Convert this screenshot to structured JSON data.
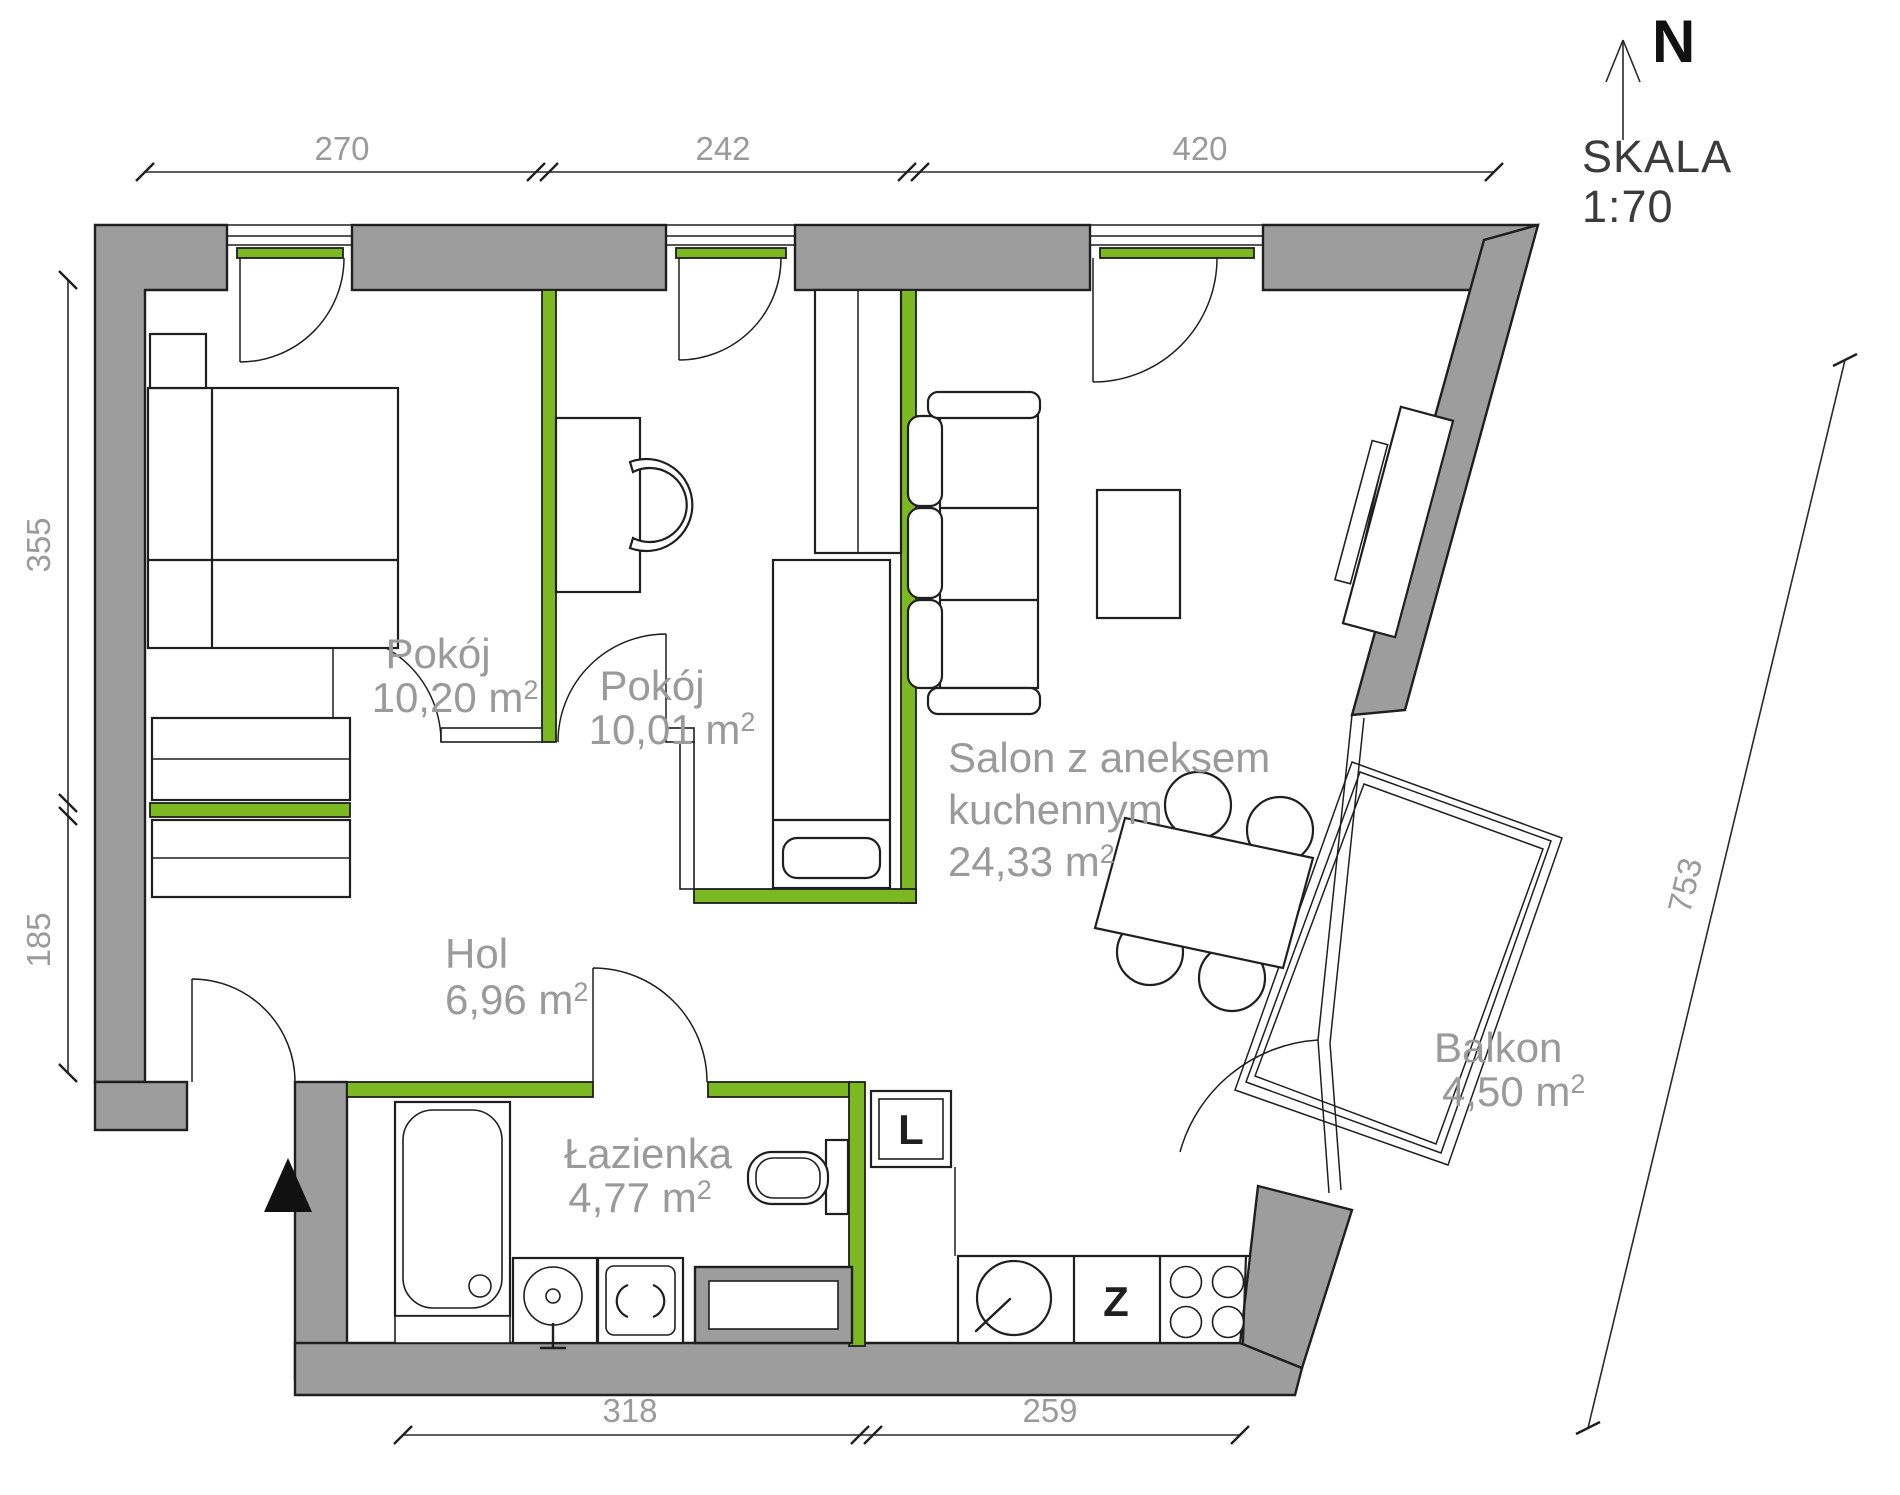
{
  "compass": {
    "north_label": "N"
  },
  "scale": {
    "label": "SKALA",
    "value": "1:70"
  },
  "rooms": {
    "room1": {
      "name": "Pokój",
      "area": "10,20 m",
      "area_sup": "2"
    },
    "room2": {
      "name": "Pokój",
      "area": "10,01 m",
      "area_sup": "2"
    },
    "salon": {
      "name_line1": "Salon z aneksem",
      "name_line2": "kuchennym",
      "area": "24,33 m",
      "area_sup": "2"
    },
    "hol": {
      "name": "Hol",
      "area": "6,96 m",
      "area_sup": "2"
    },
    "bathroom": {
      "name": "Łazienka",
      "area": "4,77 m",
      "area_sup": "2"
    },
    "balcony": {
      "name": "Balkon",
      "area": "4,50 m",
      "area_sup": "2"
    }
  },
  "dimensions": {
    "top": [
      "270",
      "242",
      "420"
    ],
    "left": [
      "355",
      "185"
    ],
    "bottom": [
      "318",
      "259"
    ],
    "right": [
      "753"
    ]
  },
  "appliances": {
    "fridge": "L",
    "dishwasher": "Z"
  },
  "colors": {
    "wall_gray": "#9d9d9d",
    "accent_green": "#7cb821",
    "label_gray": "#9a9a9a",
    "line_black": "#1f1f1f"
  }
}
